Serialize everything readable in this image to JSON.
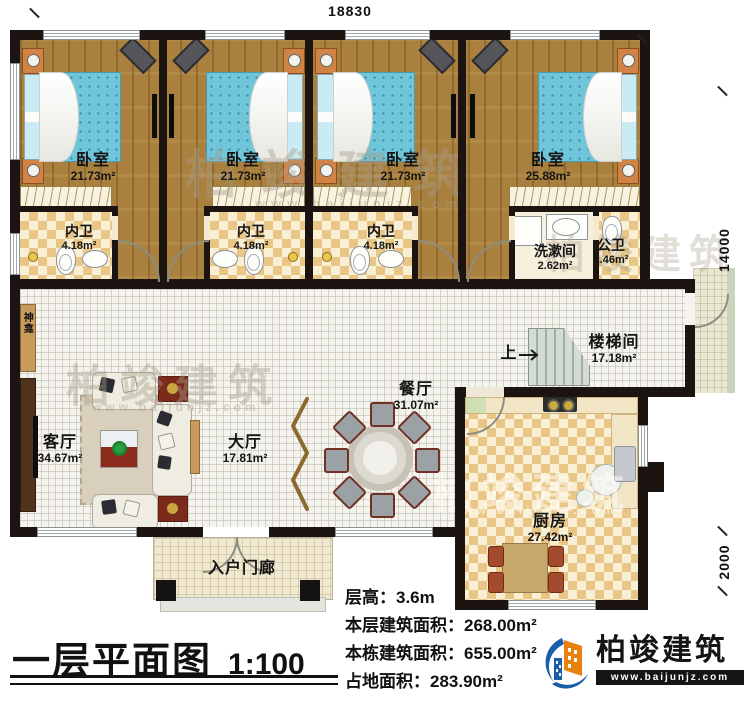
{
  "plan": {
    "dimensions": {
      "top": "18830",
      "right_upper": "14000",
      "right_lower": "2000"
    },
    "rooms": {
      "bedroom1": {
        "name": "卧室",
        "area": "21.73m²"
      },
      "bedroom2": {
        "name": "卧室",
        "area": "21.73m²"
      },
      "bedroom3": {
        "name": "卧室",
        "area": "21.73m²"
      },
      "bedroom4": {
        "name": "卧室",
        "area": "25.88m²"
      },
      "ensuite1": {
        "name": "内卫",
        "area": "4.18m²"
      },
      "ensuite2": {
        "name": "内卫",
        "area": "4.18m²"
      },
      "ensuite3": {
        "name": "内卫",
        "area": "4.18m²"
      },
      "washroom": {
        "name": "洗漱间",
        "area": "2.62m²"
      },
      "public_wc": {
        "name": "公卫",
        "area": "2.46m²"
      },
      "stairwell": {
        "name": "楼梯间",
        "area": "17.18m²",
        "direction": "上"
      },
      "dining": {
        "name": "餐厅",
        "area": "31.07m²"
      },
      "hall": {
        "name": "大厅",
        "area": "17.81m²"
      },
      "living": {
        "name": "客厅",
        "area": "34.67m²"
      },
      "kitchen": {
        "name": "厨房",
        "area": "27.42m²"
      },
      "entry_porch": {
        "name": "入户门廊"
      },
      "shrine": {
        "name": "神龛"
      }
    }
  },
  "title_block": {
    "title": "一层平面图",
    "scale": "1:100",
    "stats": [
      {
        "label": "层高：",
        "value": "3.6m"
      },
      {
        "label": "本层建筑面积：",
        "value": "268.00m²"
      },
      {
        "label": "本栋建筑面积：",
        "value": "655.00m²"
      },
      {
        "label": "占地面积：",
        "value": "283.90m²"
      }
    ]
  },
  "branding": {
    "company": "柏竣建筑",
    "website": "www.baijunjz.com"
  },
  "watermark": {
    "text": "柏竣建筑",
    "site": "www.baijunjz.com"
  }
}
